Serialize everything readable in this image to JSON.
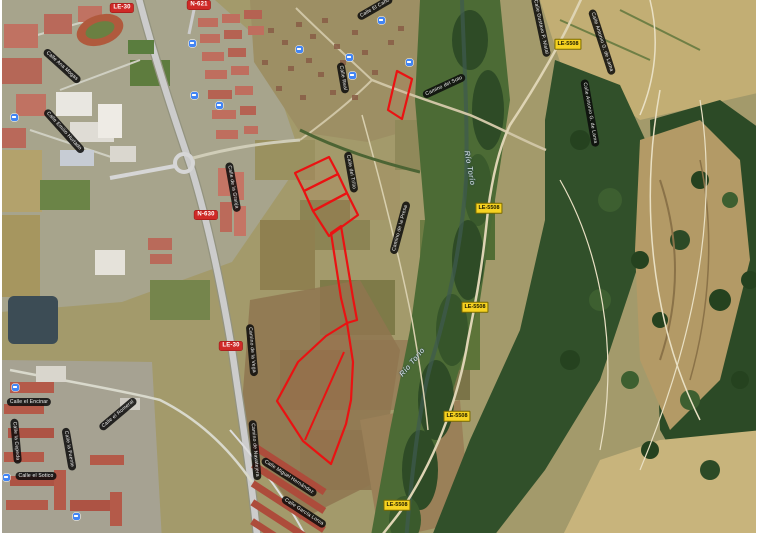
{
  "colors": {
    "annotation_red": "#ea1212",
    "national_shield_red": "#cf2a27",
    "provincial_shield_yellow": "#f6d221",
    "street_pill_black": "#0a0a0a",
    "water_label": "#e3edf4"
  },
  "road_shields": [
    {
      "text": "LE-30",
      "type": "red",
      "x": 120,
      "y": 8
    },
    {
      "text": "N-621",
      "type": "red",
      "x": 197,
      "y": 5
    },
    {
      "text": "N-630",
      "type": "red",
      "x": 204,
      "y": 215
    },
    {
      "text": "LE-30",
      "type": "red",
      "x": 229,
      "y": 346
    },
    {
      "text": "LE-5508",
      "type": "yellow",
      "x": 566,
      "y": 44
    },
    {
      "text": "LE-5508",
      "type": "yellow",
      "x": 487,
      "y": 208
    },
    {
      "text": "LE-5508",
      "type": "yellow",
      "x": 473,
      "y": 307
    },
    {
      "text": "LE-5508",
      "type": "yellow",
      "x": 455,
      "y": 416
    },
    {
      "text": "LE-5508",
      "type": "yellow",
      "x": 395,
      "y": 505
    }
  ],
  "water_labels": [
    {
      "text": "Río Torío",
      "x": 468,
      "y": 168,
      "rot": 80
    },
    {
      "text": "Río Torío",
      "x": 410,
      "y": 362,
      "rot": -50
    }
  ],
  "street_labels": [
    {
      "text": "Calle Ana Mogas",
      "x": 60,
      "y": 66,
      "rot": 42
    },
    {
      "text": "Calle Emilio Hurtado",
      "x": 62,
      "y": 131,
      "rot": 48
    },
    {
      "text": "Calle de la Granja",
      "x": 231,
      "y": 187,
      "rot": 80
    },
    {
      "text": "Calle El Caño",
      "x": 373,
      "y": 8,
      "rot": -30
    },
    {
      "text": "Calle Real",
      "x": 341,
      "y": 78,
      "rot": 80
    },
    {
      "text": "Camino del Soto",
      "x": 442,
      "y": 86,
      "rot": -25
    },
    {
      "text": "Calle del Trillo",
      "x": 349,
      "y": 172,
      "rot": 80
    },
    {
      "text": "Camino de la Presa",
      "x": 398,
      "y": 228,
      "rot": -75
    },
    {
      "text": "Calle Gustavo P. Nistal",
      "x": 539,
      "y": 27,
      "rot": 78
    },
    {
      "text": "Calle Antonio G. de Lama",
      "x": 600,
      "y": 42,
      "rot": 72
    },
    {
      "text": "Calle Antonio G. de Lama",
      "x": 588,
      "y": 113,
      "rot": 80
    },
    {
      "text": "Camino de la Vega",
      "x": 250,
      "y": 350,
      "rot": 85
    },
    {
      "text": "Camino de Navatejera",
      "x": 253,
      "y": 450,
      "rot": 85
    },
    {
      "text": "Calle Miguel Hernández",
      "x": 287,
      "y": 477,
      "rot": 33
    },
    {
      "text": "Calle García Lorca",
      "x": 302,
      "y": 512,
      "rot": 33
    },
    {
      "text": "Calle el Encinar",
      "x": 27,
      "y": 402,
      "rot": 0
    },
    {
      "text": "Calle la Cepeda",
      "x": 14,
      "y": 441,
      "rot": 85
    },
    {
      "text": "Calle la Fuente",
      "x": 67,
      "y": 449,
      "rot": 80
    },
    {
      "text": "Calle el Romeral",
      "x": 116,
      "y": 414,
      "rot": -40
    },
    {
      "text": "Calle el Sotico",
      "x": 34,
      "y": 476,
      "rot": 0
    }
  ],
  "transit_stops": [
    {
      "x": 190,
      "y": 43
    },
    {
      "x": 192,
      "y": 95
    },
    {
      "x": 217,
      "y": 105
    },
    {
      "x": 12,
      "y": 117
    },
    {
      "x": 297,
      "y": 49
    },
    {
      "x": 347,
      "y": 57
    },
    {
      "x": 379,
      "y": 20
    },
    {
      "x": 350,
      "y": 75
    },
    {
      "x": 407,
      "y": 62
    },
    {
      "x": 13,
      "y": 387
    },
    {
      "x": 4,
      "y": 477
    },
    {
      "x": 74,
      "y": 516
    }
  ],
  "annotations": {
    "description_color": "#ea1212",
    "parcels": [
      {
        "name": "parcel-outline-north",
        "points": "397,71 412,79 402,119 388,110"
      },
      {
        "name": "parcel-strip-1",
        "points": "295,173 329,157 338,174 304,191"
      },
      {
        "name": "parcel-strip-2",
        "points": "304,191 338,174 347,193 313,211"
      },
      {
        "name": "parcel-strip-3",
        "points": "313,211 347,193 358,215 329,236"
      },
      {
        "name": "parcel-strip-long",
        "points": "331,233 341,226 353,298 357,320 347,323 341,298"
      },
      {
        "name": "parcel-outline-south",
        "points": "347,323 353,362 351,400 346,424 331,464 303,441 277,401 298,362 326,336"
      }
    ],
    "dividers": [
      {
        "name": "parcel-south-divider",
        "points": "305,440 344,352"
      }
    ]
  }
}
